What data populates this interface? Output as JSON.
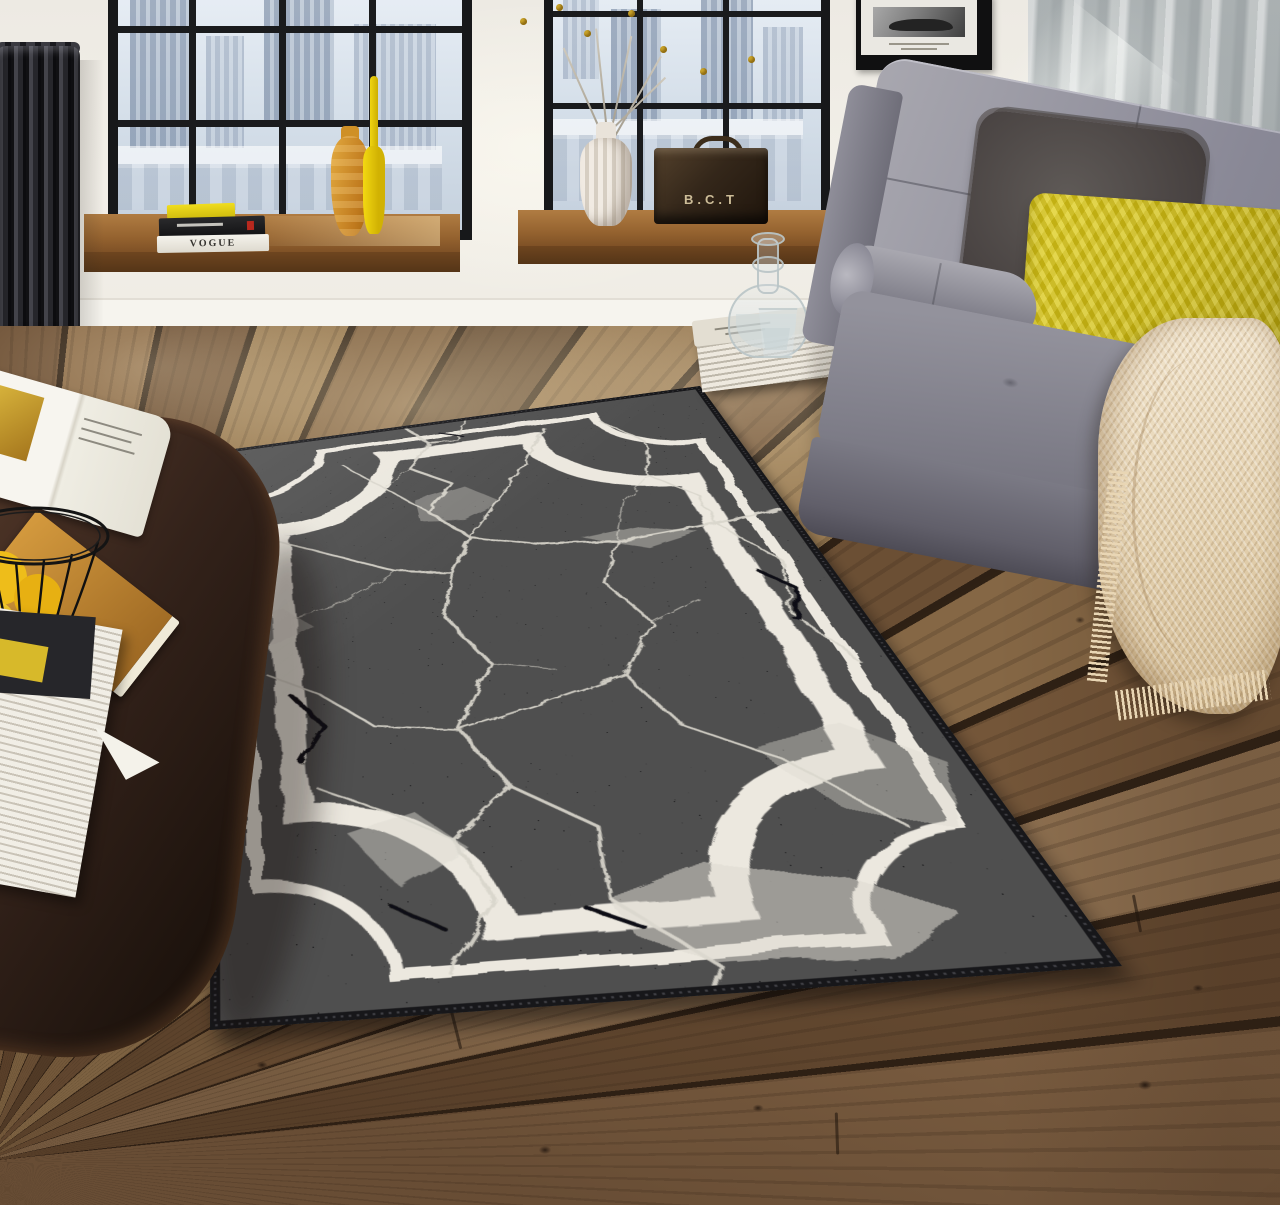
{
  "scene": {
    "type": "interior product photograph",
    "description": "Loft living room: black rug with white cracked-marble veins and a double white line border with concave scooped corners, laid diagonally on a rustic wood plank floor. Two black steel-grid windows with a pale city view, wooden sills, a dark cast-iron radiator, a gray futon sofa with cushions and a cream fringed throw, and a dark wood coffee table with magazines and a wire basket of lemons.",
    "texts": {
      "vogue_book_spine": "VOGUE",
      "storage_box_label": "B.C.T"
    },
    "palette": {
      "rug_black": "#0b0b0d",
      "rug_vein_white": "#d9d6cc",
      "rug_border_white": "#ece8df",
      "floor_plank_brown": "#7d5f40",
      "plank_gap": "#2e2014",
      "wall_white": "#efece6",
      "wall_concrete_gray": "#b0b5b6",
      "window_frame_black": "#17181a",
      "glass_sky": "#dde7f0",
      "sill_wood": "#94622f",
      "sofa_gray": "#8a8994",
      "pillow_yellow": "#d4c117",
      "cushion_charcoal": "#4f4a47",
      "throw_cream": "#ead9bd",
      "radiator_charcoal": "#232327",
      "vase_amber": "#cd8f2c",
      "bottle_yellow": "#e7c50e",
      "lemon_yellow": "#eebd1a",
      "table_walnut": "#33221a",
      "box_leather_brown": "#34271a",
      "vase_white": "#e9e3db"
    },
    "objects": {
      "rug": "black marble-print area rug with double white border, concave corners, dark stitched binding",
      "floor": "reclaimed wood planks radiating toward lower-left vanishing point with knots and joints",
      "left_window": "black grid window with city view, wooden sill, book stack (yellow, black, VOGUE), amber vase, slim yellow bottle",
      "right_window": "black grid window, white ribbed vase with dried craspedia stems, vintage leather box labeled B.C.T",
      "radiator": "dark cast-iron column radiator",
      "picture": "framed black-and-white race car photograph",
      "sofa": "gray fabric futon sofa with chrome legs, gray bolster, charcoal ruffled cushion, yellow pleated pillow",
      "throw": "cream herringbone throw blanket with fringe",
      "coffee_table": "dark walnut oval coffee table with open magazine, amber magazine, white magazine stack, black wire basket of lemons",
      "decanter_set": "glass water decanter and tumbler on a stack of magazines on the floor"
    }
  }
}
